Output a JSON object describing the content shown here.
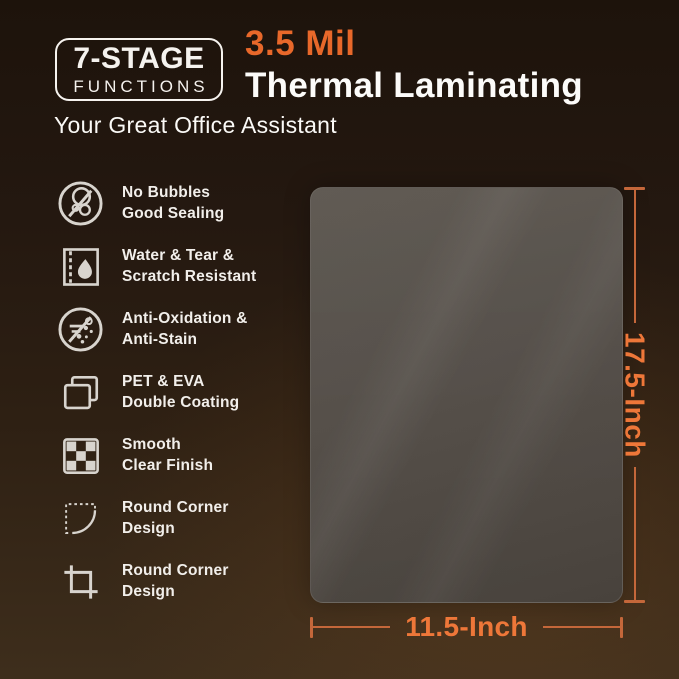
{
  "theme": {
    "accent": "#e8682a",
    "dimension_line": "#c4673a",
    "dimension_text": "#ee7739",
    "icon": "#d8d4ce",
    "text_light": "#f5f2ee",
    "sheet": "#56504a",
    "bg_top": "#1d130b",
    "bg_bottom": "#3e2e1c"
  },
  "header": {
    "badge_line1": "7-STAGE",
    "badge_line2": "FUNCTIONS",
    "title_accent": "3.5 Mil",
    "title_main": "Thermal Laminating",
    "subtitle": "Your Great Office Assistant"
  },
  "features": [
    {
      "icon": "no-bubbles-icon",
      "line1": "No Bubbles",
      "line2": "Good Sealing"
    },
    {
      "icon": "water-tear-icon",
      "line1": "Water & Tear &",
      "line2": "Scratch Resistant"
    },
    {
      "icon": "anti-oxidation-icon",
      "line1": "Anti-Oxidation &",
      "line2": "Anti-Stain"
    },
    {
      "icon": "double-coating-icon",
      "line1": "PET & EVA",
      "line2": "Double Coating"
    },
    {
      "icon": "smooth-finish-icon",
      "line1": "Smooth",
      "line2": "Clear Finish"
    },
    {
      "icon": "round-corner-dashed-icon",
      "line1": "Round Corner",
      "line2": "Design"
    },
    {
      "icon": "round-corner-crop-icon",
      "line1": "Round Corner",
      "line2": "Design"
    }
  ],
  "product": {
    "height_label": "17.5-Inch",
    "width_label": "11.5-Inch"
  }
}
